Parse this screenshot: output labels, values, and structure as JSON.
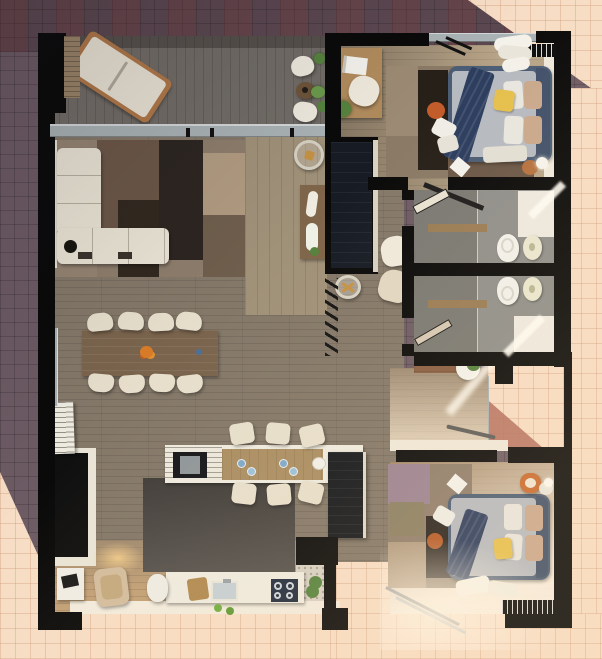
{
  "meta": {
    "scene": "apartment-floor-plan-3d-render",
    "view": "top-down",
    "lighting": "daylight-with-cast-shadow"
  },
  "palette": {
    "tile-shadow": "#6d5b64",
    "tile-shadow-dark": "#5b4750",
    "tile-sun": "#f7ddc5",
    "tile-sun-line": "#d9b394",
    "deck": "#716c66",
    "floor-main": "#847869",
    "floor-warm": "#c2a077",
    "floor-bed1": "#998871",
    "floor-bed2": "#c8ab8a",
    "floor-bath": "#8f8f8b",
    "shower": "#7a7973",
    "floor-hall": "#c4ad8e",
    "terrazzo": "#d8d1c4",
    "wall": "#0a0a0a",
    "cab-navy": "#161b24",
    "white-trim": "#e9e4d6",
    "sofa": "#eae4d5",
    "chair": "#e7dfcc",
    "wood-table": "#7a644d",
    "wood-console": "#7f6549",
    "island-wood": "#aa8e63",
    "counter": "#efebe0",
    "rug-base": "#8d7d6b",
    "rug-dark": "#2c2520",
    "rug-brown": "#6b5747",
    "rug-tan": "#b19b81",
    "rug-mauve": "#9b8292",
    "bed-frame": "#4b5d75",
    "mattress": "#b6bac1",
    "runner": "#2b3c5e",
    "pillow-yellow": "#e6c04d",
    "pillow-beige": "#c9a88c",
    "orange": "#c4662e",
    "plant": "#55823d",
    "glass": "#a9b2b5",
    "stove": "#202c3e",
    "sink": "#c6cfd5",
    "terracotta": "#b5705f",
    "kitchen-rug": "#4b4743",
    "wicker": "#d3bd9d"
  },
  "exterior": {
    "areas": [
      "shaded-paving",
      "sunlit-paving",
      "side-light-well",
      "terracotta-patio-corner"
    ]
  },
  "rooms": [
    {
      "id": "terrace",
      "label": "Terrace",
      "furniture": [
        "sun-lounger",
        "bistro-table",
        "bistro-chair",
        "bistro-chair",
        "potted-plants",
        "timber-privacy-screen",
        "glass-balustrade"
      ]
    },
    {
      "id": "living-room",
      "label": "Living Room",
      "furniture": [
        "l-shaped-sofa",
        "floor-lamp",
        "patchwork-rug",
        "console-table",
        "glass-side-table",
        "decor-tray",
        "accent-armchair",
        "accent-armchair",
        "media-wardrobe-divider",
        "decor-ladder"
      ]
    },
    {
      "id": "dining-area",
      "label": "Dining Area",
      "furniture": [
        "dining-table",
        "dining-chair-x8",
        "fruit-bowl"
      ]
    },
    {
      "id": "kitchen",
      "label": "Kitchen",
      "furniture": [
        "island-with-sink",
        "bar-stool-x6",
        "tall-fridge-unit",
        "worktop-with-hob",
        "worktop-sink",
        "cutting-board",
        "potted-plant",
        "dark-area-rug",
        "shutter-stack"
      ]
    },
    {
      "id": "bedroom-1",
      "label": "Bedroom 1",
      "furniture": [
        "double-bed",
        "navy-throw-runner",
        "yellow-pillow",
        "beige-pillows",
        "desk",
        "desk-chair",
        "laptop",
        "potted-plant",
        "patchwork-rug",
        "orange-pouf",
        "curtains",
        "sliding-wardrobe",
        "side-table-with-lamp",
        "door"
      ]
    },
    {
      "id": "bathroom-1",
      "label": "Bathroom 1",
      "furniture": [
        "toilet",
        "bidet",
        "vanity-shelf",
        "walk-in-shower",
        "door"
      ]
    },
    {
      "id": "bathroom-2",
      "label": "Bathroom 2",
      "furniture": [
        "toilet",
        "bidet",
        "vanity-shelf",
        "walk-in-shower",
        "door"
      ]
    },
    {
      "id": "hallway",
      "label": "Hallway",
      "furniture": [
        "bench",
        "pedestal-basin",
        "potted-plant",
        "glass-screen",
        "door"
      ]
    },
    {
      "id": "bedroom-2",
      "label": "Bedroom 2",
      "furniture": [
        "double-bed",
        "navy-throw-runner",
        "yellow-pillow",
        "beige-pillows",
        "patchwork-rug",
        "orange-armchair",
        "orange-pouf",
        "sliding-wardrobe",
        "side-table-with-lamp",
        "open-glass-doors"
      ]
    },
    {
      "id": "sitting-nook",
      "label": "Sitting Nook",
      "furniture": [
        "black-sideboard",
        "wicker-armchair",
        "drum-stool",
        "side-table-with-tray"
      ]
    },
    {
      "id": "wc-laundry",
      "label": "WC / Laundry",
      "furniture": [
        "potted-plant"
      ]
    }
  ]
}
